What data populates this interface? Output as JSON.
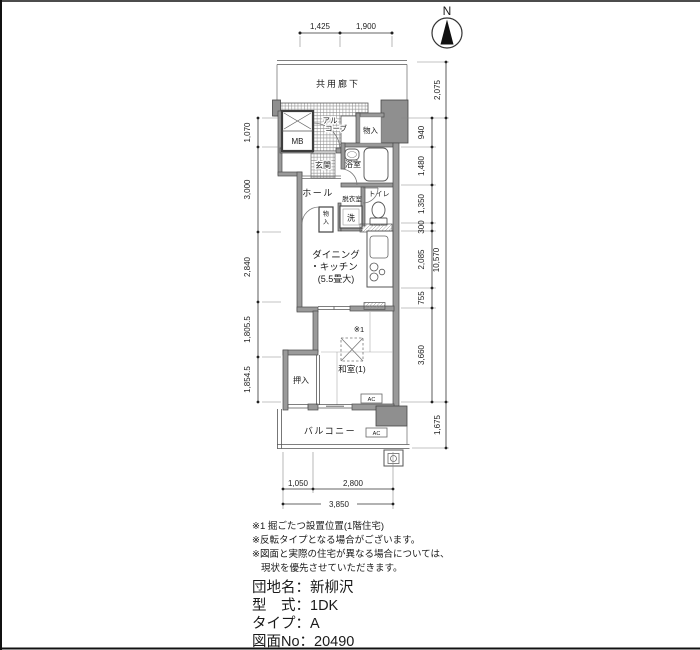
{
  "compass": {
    "label": "N"
  },
  "corridor": {
    "label": "共用廊下"
  },
  "rooms": {
    "alcove_line1": "アル",
    "alcove_line2": "コーブ",
    "meter_box": "MB",
    "storage_top": "物入",
    "entrance": "玄関",
    "bathroom": "浴室",
    "hall": "ホール",
    "dressing_room": "脱衣室",
    "toilet": "トイレ",
    "storage_hall": "物入",
    "washer": "洗",
    "dk_line1": "ダイニング",
    "dk_line2": "・キッチン",
    "dk_line3": "(5.5畳大)",
    "kotatsu_ref": "※1",
    "japanese_room": "和室(1)",
    "closet": "押入",
    "balcony": "バルコニー",
    "ac_unit_room": "AC",
    "ac_unit_balcony": "AC"
  },
  "dimensions": {
    "top": [
      "1,425",
      "1,900"
    ],
    "left": [
      "1,070",
      "3,000",
      "2,840",
      "1,805.5",
      "1,854.5"
    ],
    "right_inner": [
      "940",
      "1,480",
      "1,350",
      "300",
      "2,085",
      "755",
      "3,660"
    ],
    "right_outer": [
      "2,075",
      "10,570",
      "1,675"
    ],
    "bottom_segments": [
      "1,050",
      "2,800"
    ],
    "bottom_total": "3,850"
  },
  "notes": {
    "line1": "※1 掘ごたつ設置位置(1階住宅)",
    "line2": "※反転タイプとなる場合がございます。",
    "line3": "※図面と実際の住宅が異なる場合については、",
    "line4": "現状を優先させていただきます。"
  },
  "info": {
    "separator": "：",
    "rows": [
      {
        "label": "団地名",
        "value": "新柳沢"
      },
      {
        "label": "型　式",
        "value": "1DK"
      },
      {
        "label": "タイプ",
        "value": "A"
      },
      {
        "label": "図面No",
        "value": "20490"
      }
    ]
  }
}
